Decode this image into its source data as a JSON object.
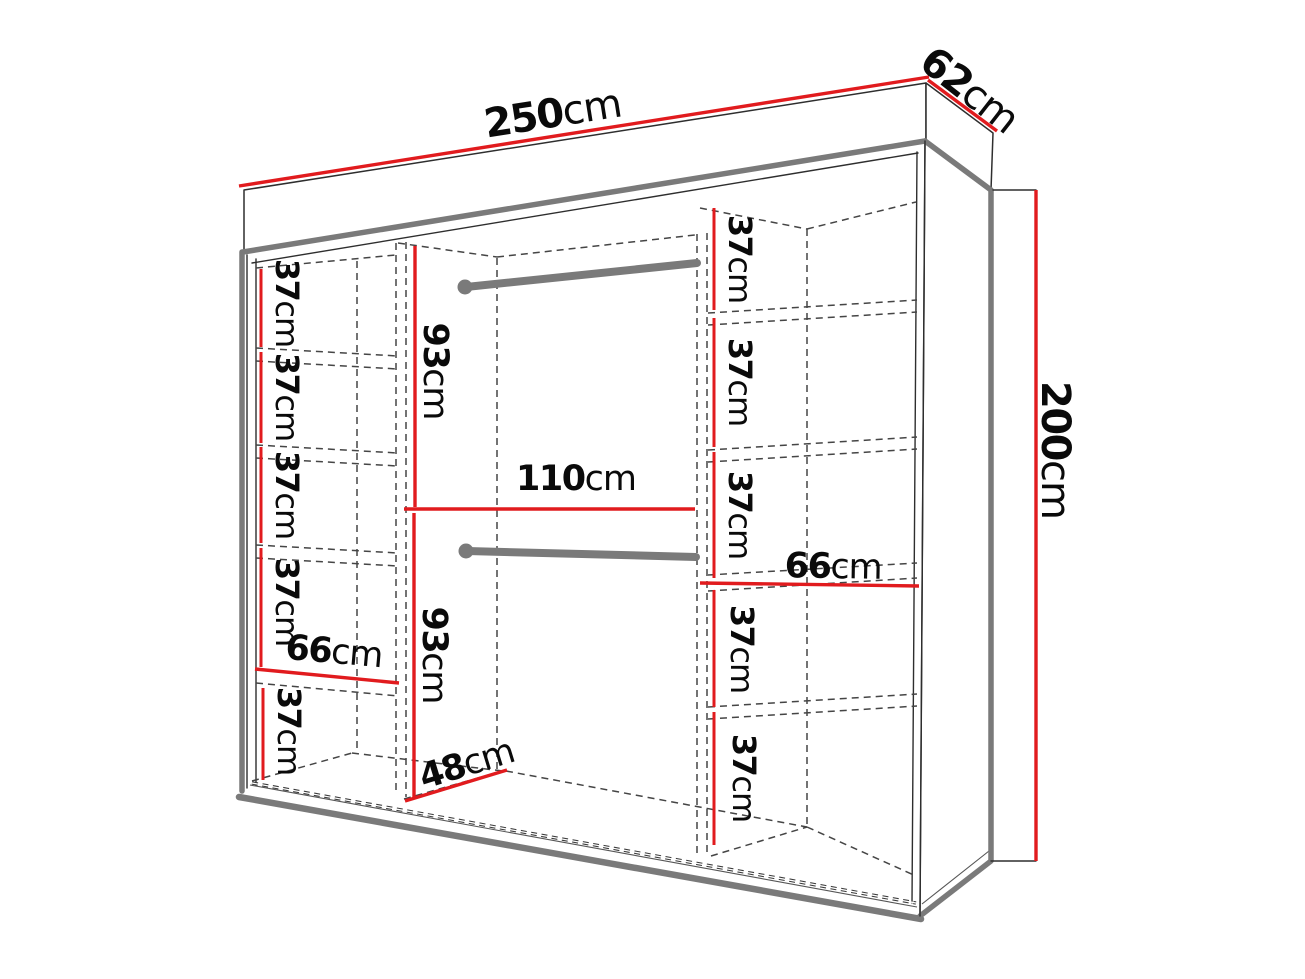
{
  "page": {
    "background": "#ffffff",
    "description": "Wardrobe interior dimension diagram, perspective line drawing"
  },
  "colors": {
    "dimension_red": "#e11b1e",
    "edge_gray": "#7a7a7a",
    "line_black": "#2e2e2e",
    "dashed_gray": "#454545",
    "label_black": "#0a0a0a"
  },
  "unit_default": "cm",
  "dimensions": {
    "overall_width": {
      "value": "250",
      "unit": "cm"
    },
    "overall_depth": {
      "value": "62",
      "unit": "cm"
    },
    "overall_height": {
      "value": "200",
      "unit": "cm"
    },
    "hanging_width": {
      "value": "110",
      "unit": "cm"
    },
    "hanging_top_height": {
      "value": "93",
      "unit": "cm"
    },
    "hanging_bottom_height": {
      "value": "93",
      "unit": "cm"
    },
    "interior_depth": {
      "value": "48",
      "unit": "cm"
    },
    "left_column_width": {
      "value": "66",
      "unit": "cm"
    },
    "right_column_width": {
      "value": "66",
      "unit": "cm"
    },
    "left_shelf_heights": [
      {
        "value": "37",
        "unit": "cm"
      },
      {
        "value": "37",
        "unit": "cm"
      },
      {
        "value": "37",
        "unit": "cm"
      },
      {
        "value": "37",
        "unit": "cm"
      },
      {
        "value": "37",
        "unit": "cm"
      }
    ],
    "right_shelf_heights": [
      {
        "value": "37",
        "unit": "cm"
      },
      {
        "value": "37",
        "unit": "cm"
      },
      {
        "value": "37",
        "unit": "cm"
      },
      {
        "value": "37",
        "unit": "cm"
      },
      {
        "value": "37",
        "unit": "cm"
      }
    ]
  }
}
